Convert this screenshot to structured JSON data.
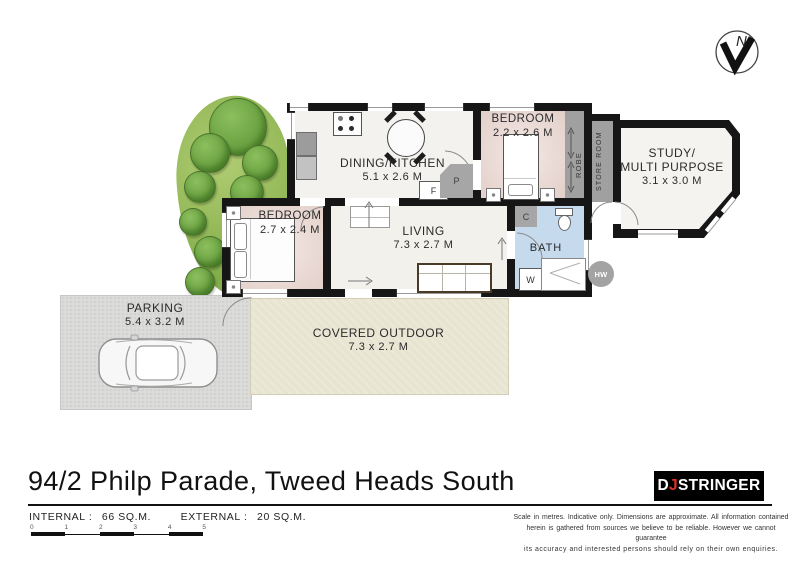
{
  "page": {
    "title": "94/2 Philp Parade, Tweed Heads South"
  },
  "compass": {
    "label": "N"
  },
  "rooms": {
    "dining_kitchen": {
      "name": "DINING/KITCHEN",
      "dims": "5.1 x 2.6 M"
    },
    "bedroom_rear": {
      "name": "BEDROOM",
      "dims": "2.2 x 2.6 M"
    },
    "study": {
      "name_line1": "STUDY/",
      "name_line2": "MULTI PURPOSE",
      "dims": "3.1 x 3.0 M"
    },
    "bedroom_front": {
      "name": "BEDROOM",
      "dims": "2.7 x 2.4 M"
    },
    "living": {
      "name": "LIVING",
      "dims": "7.3 x 2.7 M"
    },
    "bath": {
      "name": "BATH"
    },
    "robe": {
      "name": "ROBE"
    },
    "store_room": {
      "name": "STORE ROOM"
    },
    "parking": {
      "name": "PARKING",
      "dims": "5.4 x 3.2 M"
    },
    "covered_outdoor": {
      "name": "COVERED OUTDOOR",
      "dims": "7.3 x 2.7 M"
    }
  },
  "fixtures": {
    "fridge": "F",
    "pantry": "P",
    "cupboard": "C",
    "washer": "W",
    "hot_water": "HW"
  },
  "areas": {
    "internal_label": "INTERNAL :",
    "internal_value": "66 SQ.M.",
    "external_label": "EXTERNAL :",
    "external_value": "20 SQ.M."
  },
  "scale_bar": {
    "ticks": [
      "0",
      "1",
      "2",
      "3",
      "4",
      "5"
    ]
  },
  "logo": {
    "prefix": "D",
    "accent": "J",
    "suffix": "STRINGER"
  },
  "disclaimer": {
    "line1": "Scale in metres.  Indicative only.  Dimensions are approximate.  All information contained",
    "line2": "herein is gathered from sources we believe to be reliable.  However we cannot guarantee",
    "line3": "its accuracy and interested persons should rely on their own enquiries."
  },
  "colors": {
    "wall": "#161616",
    "floor": "#f3f1ec",
    "bedroom_floor": "#e9d8d3",
    "bath_floor": "#c6daee",
    "outdoor": "#ece8d6",
    "parking": "#dcdcda",
    "fixture_gray": "#a6a6a6",
    "garden_green": "#86b14c",
    "logo_accent": "#e0312a"
  }
}
